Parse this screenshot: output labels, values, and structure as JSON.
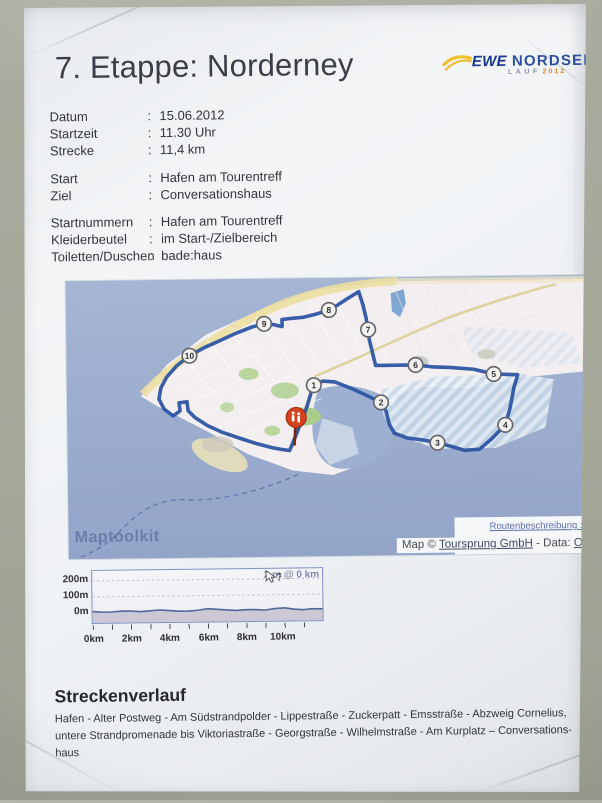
{
  "photo": {
    "background_color": "#a5a899",
    "paper_color": "#eef1f4"
  },
  "header": {
    "title": "7. Etappe: Norderney",
    "logo": {
      "brand": "EWE",
      "name": "NORDSEE",
      "sub_label": "LAUF",
      "sub_year": "2012",
      "swoosh_color": "#f0c12c",
      "brand_color": "#16398f",
      "year_color": "#e2892f"
    }
  },
  "details": {
    "separator": ":",
    "rows_primary": [
      {
        "label": "Datum",
        "value": "15.06.2012"
      },
      {
        "label": "Startzeit",
        "value": "11.30 Uhr"
      },
      {
        "label": "Strecke",
        "value": "11,4 km"
      }
    ],
    "rows_start_finish": [
      {
        "label": "Start",
        "value": "Hafen am Tourentreff"
      },
      {
        "label": "Ziel",
        "value": "Conversationshaus"
      }
    ],
    "rows_logistics": [
      {
        "label": "Startnummern",
        "value": "Hafen am Tourentreff"
      },
      {
        "label": "Kleiderbeutel",
        "value": "im Start-/Zielbereich"
      },
      {
        "label": "Toiletten/Duschen",
        "value": "bade:haus"
      }
    ]
  },
  "map": {
    "watermark": "Maptoolkit",
    "route_link_label": "Routenbeschreibung :",
    "attribution": {
      "prefix": "Map © ",
      "link1": "Toursprung GmbH",
      "middle": " - Data: ",
      "link2": "O"
    },
    "markers": [
      {
        "label": "1",
        "x": 247,
        "y": 107
      },
      {
        "label": "2",
        "x": 314,
        "y": 125
      },
      {
        "label": "3",
        "x": 370,
        "y": 166
      },
      {
        "label": "4",
        "x": 438,
        "y": 149
      },
      {
        "label": "5",
        "x": 427,
        "y": 98
      },
      {
        "label": "6",
        "x": 349,
        "y": 88
      },
      {
        "label": "7",
        "x": 302,
        "y": 52
      },
      {
        "label": "8",
        "x": 263,
        "y": 32
      },
      {
        "label": "9",
        "x": 198,
        "y": 45
      },
      {
        "label": "10",
        "x": 123,
        "y": 76
      }
    ],
    "colors": {
      "sea": "#a0b1d2",
      "land": "#f3eef0",
      "route": "#2d55a3",
      "beach": "#ecdfa2",
      "marker_fill": "#f2f1ee",
      "start_pin": "#d8431f",
      "hatch_light": "#eaf1f7",
      "hatch_dark": "#c7d8e8"
    }
  },
  "chart_data": {
    "type": "area",
    "x_km": [
      0,
      0.5,
      1,
      1.5,
      2,
      2.5,
      3,
      3.5,
      4,
      4.5,
      5,
      5.5,
      6,
      6.5,
      7,
      7.5,
      8,
      8.5,
      9,
      9.5,
      10,
      10.5,
      11,
      11.4
    ],
    "elevation_m": [
      2,
      1,
      1,
      2,
      2,
      1,
      2,
      3,
      2,
      1,
      1,
      2,
      4,
      3,
      2,
      1,
      2,
      2,
      1,
      3,
      4,
      2,
      1,
      2
    ],
    "xlim_km": [
      0,
      12
    ],
    "ylim_m": [
      -62,
      262
    ],
    "x_tick_labels": [
      "0km",
      "2km",
      "4km",
      "6km",
      "8km",
      "10km"
    ],
    "y_tick_labels": [
      "200m",
      "100m",
      "0m"
    ],
    "cursor_label": "2 m @ 0 km",
    "grid": "dotted-horizontal-100m-200m",
    "line_color": "#51669c",
    "fill_below_color": "#c9c5d3"
  },
  "route_description": {
    "heading": "Streckenverlauf",
    "text": "Hafen - Alter Postweg - Am Südstrandpolder - Lippestraße - Zuckerpatt - Emsstraße - Abzweig Cornelius,\nuntere Strandpromenade bis Viktoriastraße - Georgstraße - Wilhelmstraße - Am Kurplatz – Conversations-\nhaus"
  }
}
